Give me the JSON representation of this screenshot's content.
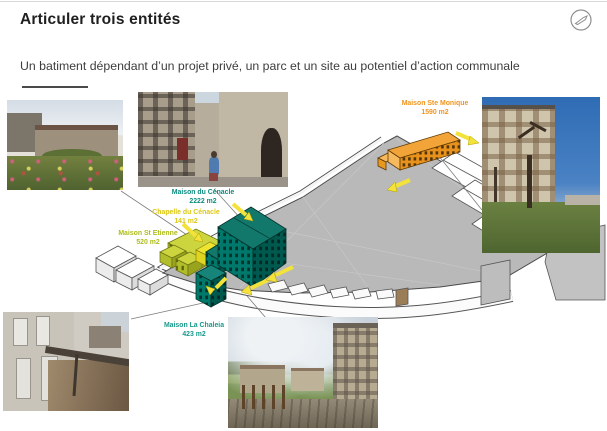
{
  "header": {
    "title": "Articuler trois entités",
    "subtitle": "Un batiment dépendant d’un projet privé, un parc et un site au potentiel d’action communale",
    "corner_icon": "pen-circle-icon"
  },
  "colors": {
    "teal_building": "#0e7568",
    "yellow_green_building": "#c3cc36",
    "bright_yellow_building": "#e8e02c",
    "orange_building": "#f2a438",
    "parc_gray": "#b9b9b9",
    "arrow_yellow": "#f2e23a",
    "label_teal": "#0d8c80",
    "label_yellow": "#ddc813",
    "label_green": "#aebd1e",
    "label_orange": "#f0951d"
  },
  "diagram": {
    "buildings": [
      {
        "name": "Maison du Cénacle",
        "area": "2222 m2",
        "color": "#0d8c80"
      },
      {
        "name": "Chapelle du Cénacle",
        "area": "141 m2",
        "color": "#ddc813"
      },
      {
        "name": "Maison St Etienne",
        "area": "520 m2",
        "color": "#aebd1e"
      },
      {
        "name": "Maison Ste Monique",
        "area": "1590 m2",
        "color": "#f0951d"
      },
      {
        "name": "Maison La Chaleia",
        "area": "423 m2",
        "color": "#19998c"
      }
    ],
    "photos": [
      {
        "id": "garden",
        "alt": "jardin fleuri devant les bâtiments"
      },
      {
        "id": "cenacle-facade",
        "alt": "façade en pierre du Cénacle avec personnage"
      },
      {
        "id": "ste-monique",
        "alt": "grande maison en pierre, arbre et pelouse"
      },
      {
        "id": "chaleia-courtyard",
        "alt": "cour et galerie de la Maison La Chaleia"
      },
      {
        "id": "village-view",
        "alt": "vue du village, mur en pierre et palissade"
      }
    ]
  }
}
